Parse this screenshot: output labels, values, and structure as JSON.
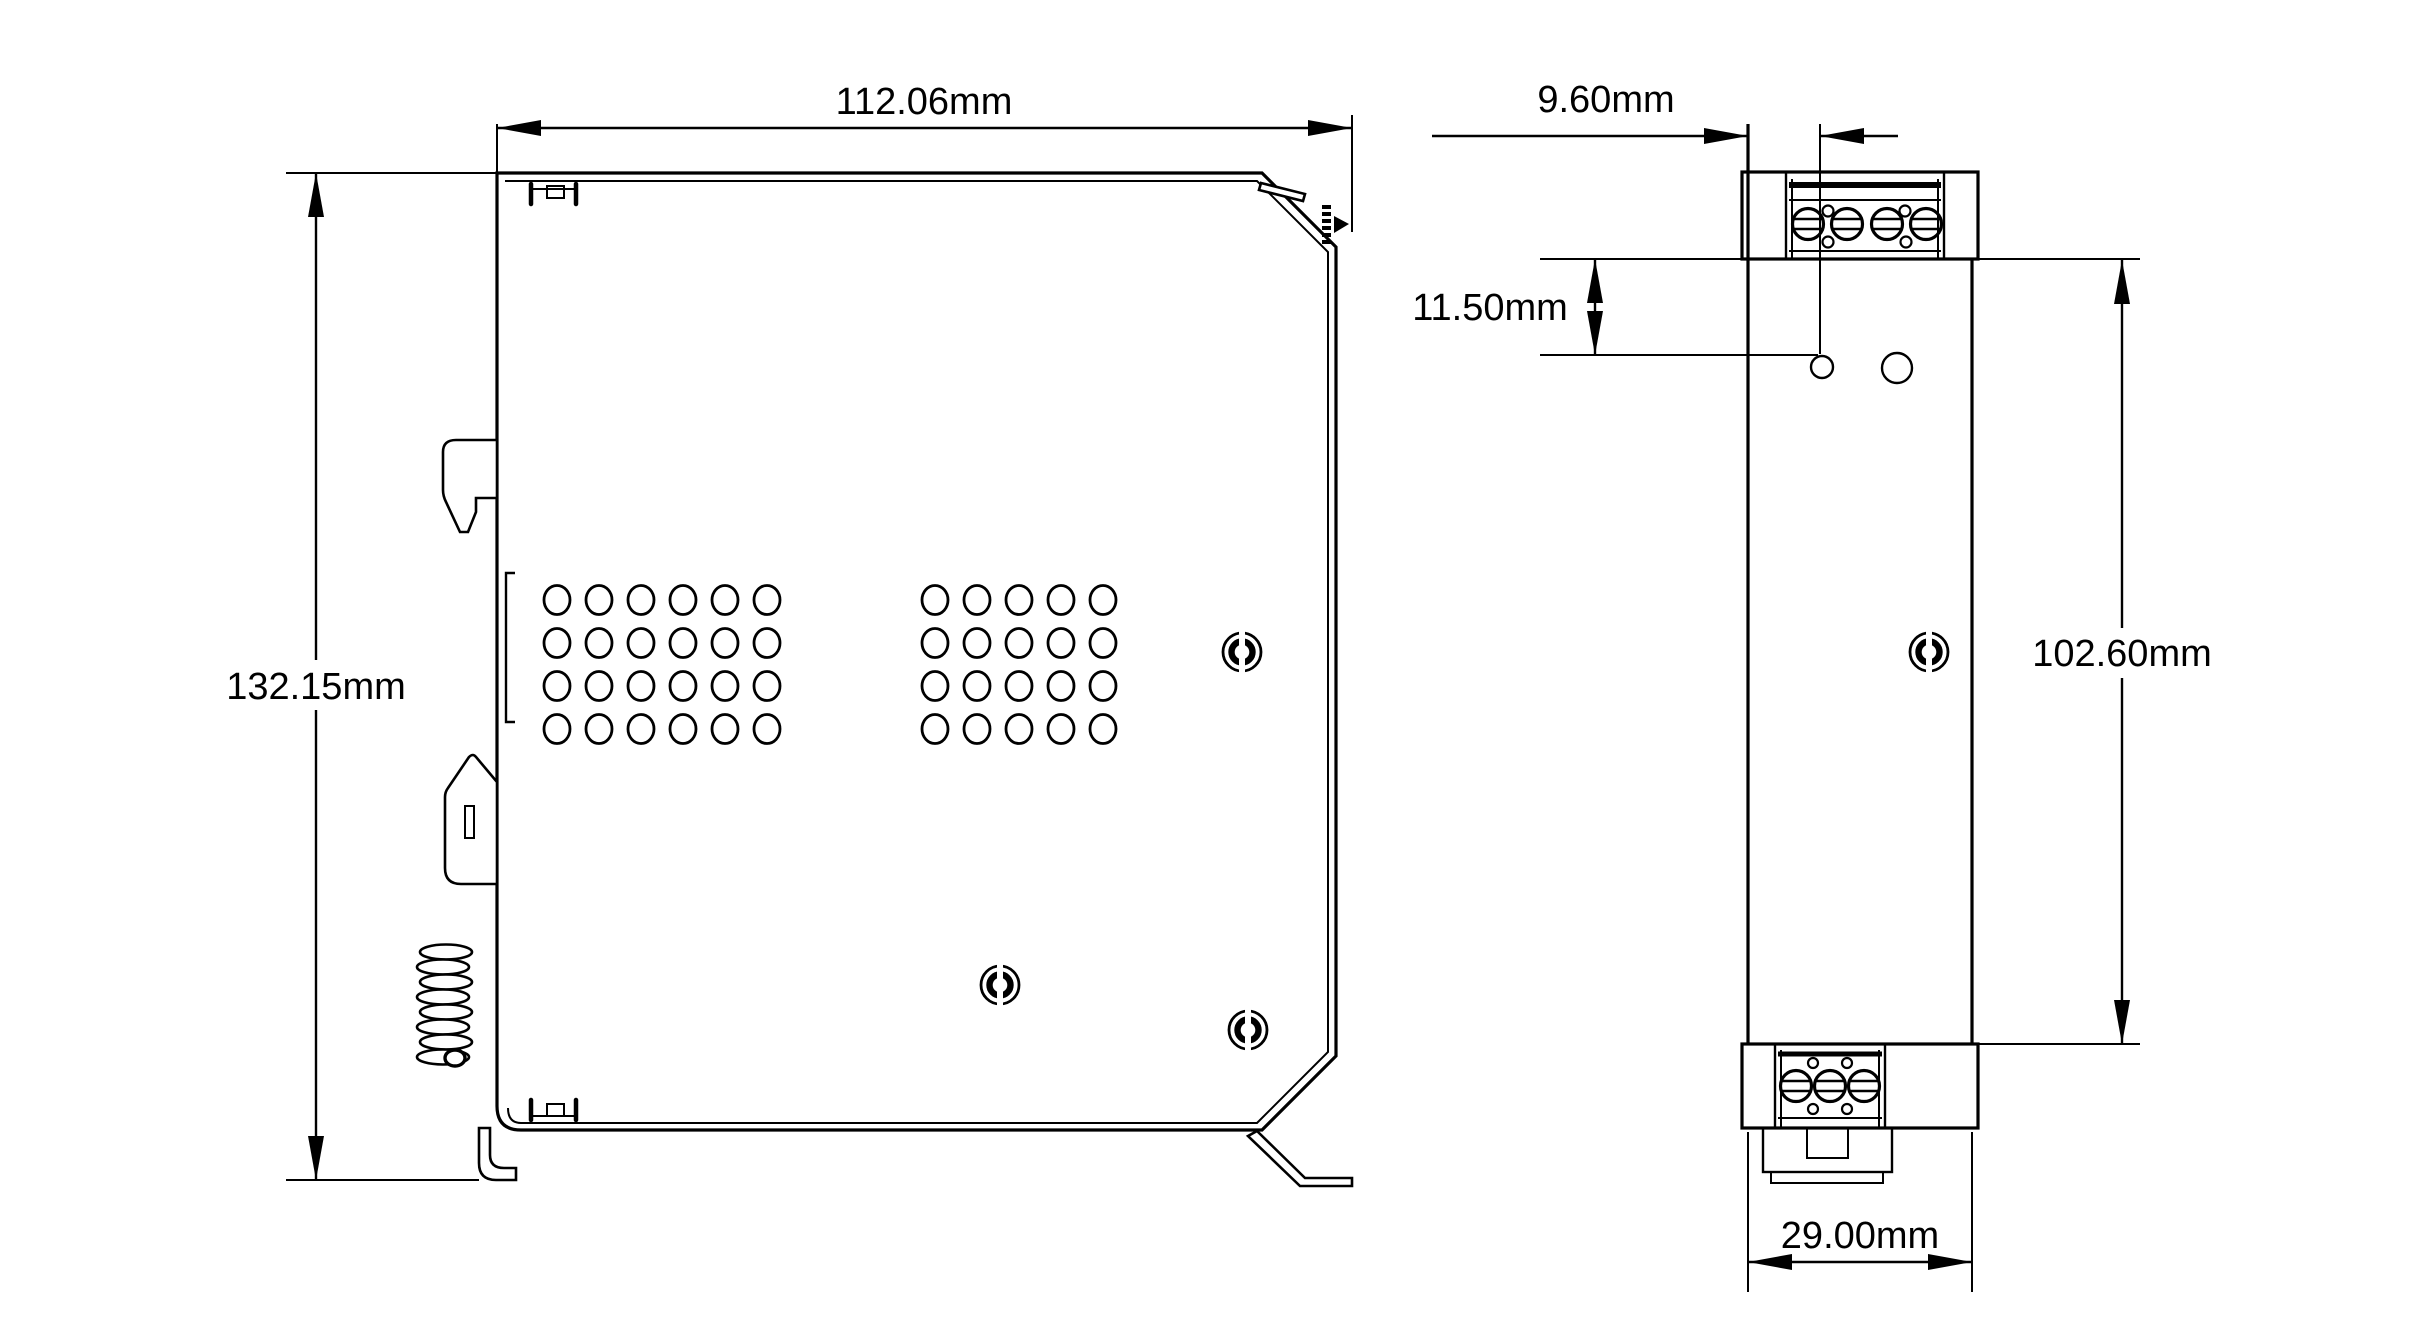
{
  "page": {
    "background_color": "#ffffff",
    "line_color": "#000000",
    "text_color": "#000000"
  },
  "drawing": {
    "kind": "technical dimension drawing",
    "unit": "mm",
    "dimensions": {
      "side_width": {
        "label": "112.06mm",
        "value": 112.06,
        "unit": "mm"
      },
      "side_height": {
        "label": "132.15mm",
        "value": 132.15,
        "unit": "mm"
      },
      "front_edge_to_hole": {
        "label": "9.60mm",
        "value": 9.6,
        "unit": "mm"
      },
      "front_top_to_hole": {
        "label": "11.50mm",
        "value": 11.5,
        "unit": "mm"
      },
      "front_body_height": {
        "label": "102.60mm",
        "value": 102.6,
        "unit": "mm"
      },
      "front_width": {
        "label": "29.00mm",
        "value": 29.0,
        "unit": "mm"
      }
    }
  }
}
